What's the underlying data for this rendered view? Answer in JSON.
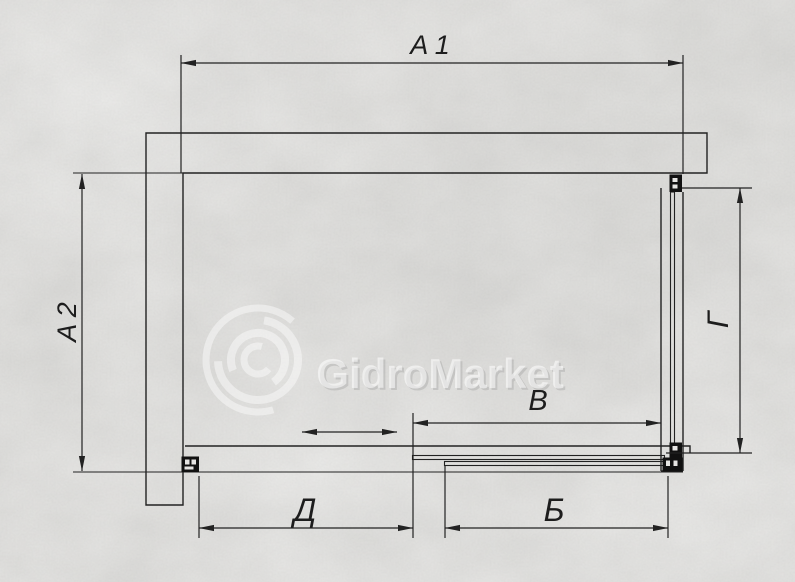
{
  "drawing": {
    "dimensions": {
      "a1": {
        "label": "A 1"
      },
      "a2": {
        "label": "A 2"
      },
      "v": {
        "label": "В"
      },
      "g": {
        "label": "Г"
      },
      "d": {
        "label": "Д"
      },
      "b": {
        "label": "Б"
      }
    },
    "watermark": {
      "text": "GidroMarket"
    },
    "colors": {
      "line": "#222222",
      "profile": "#111111",
      "background": "#d4d3d1",
      "watermark": "#ffffff"
    }
  }
}
